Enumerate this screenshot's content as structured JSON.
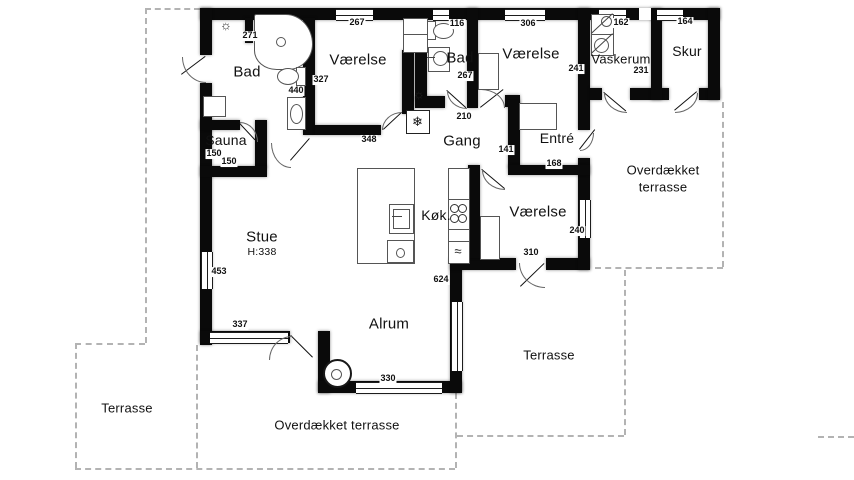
{
  "plan": {
    "rooms": {
      "bad1": "Bad",
      "vaerelse1": "Værelse",
      "bad2": "Bad",
      "vaerelse2": "Værelse",
      "vaskerum": "Vaskerum",
      "skur": "Skur",
      "sauna": "Sauna",
      "gang": "Gang",
      "entre": "Entré",
      "stue": "Stue",
      "stue_height": "H:338",
      "kokken": "Køk.",
      "vaerelse3": "Værelse",
      "alrum": "Alrum",
      "terrasse_left": "Terrasse",
      "terrasse_right": "Terrasse",
      "overdaekket_bottom": "Overdækket terrasse",
      "overdaekket_east_line1": "Overdækket",
      "overdaekket_east_line2": "terrasse"
    },
    "measurements": {
      "m267a": "267",
      "m116": "116",
      "m306": "306",
      "m162": "162",
      "m164": "164",
      "m271": "271",
      "m327": "327",
      "m440": "440",
      "m267b": "267",
      "m241": "241",
      "m231": "231",
      "m348": "348",
      "m210": "210",
      "m141": "141",
      "m168": "168",
      "m150a": "150",
      "m150b": "150",
      "m453": "453",
      "m240": "240",
      "m310": "310",
      "m624": "624",
      "m337": "337",
      "m330": "330"
    },
    "icons": {
      "lamp": "☼",
      "snowflake": "❄",
      "waves": "≈"
    },
    "colors": {
      "wall": "#0a0a0a",
      "dash": "#b3b3b3",
      "text": "#111111"
    }
  }
}
